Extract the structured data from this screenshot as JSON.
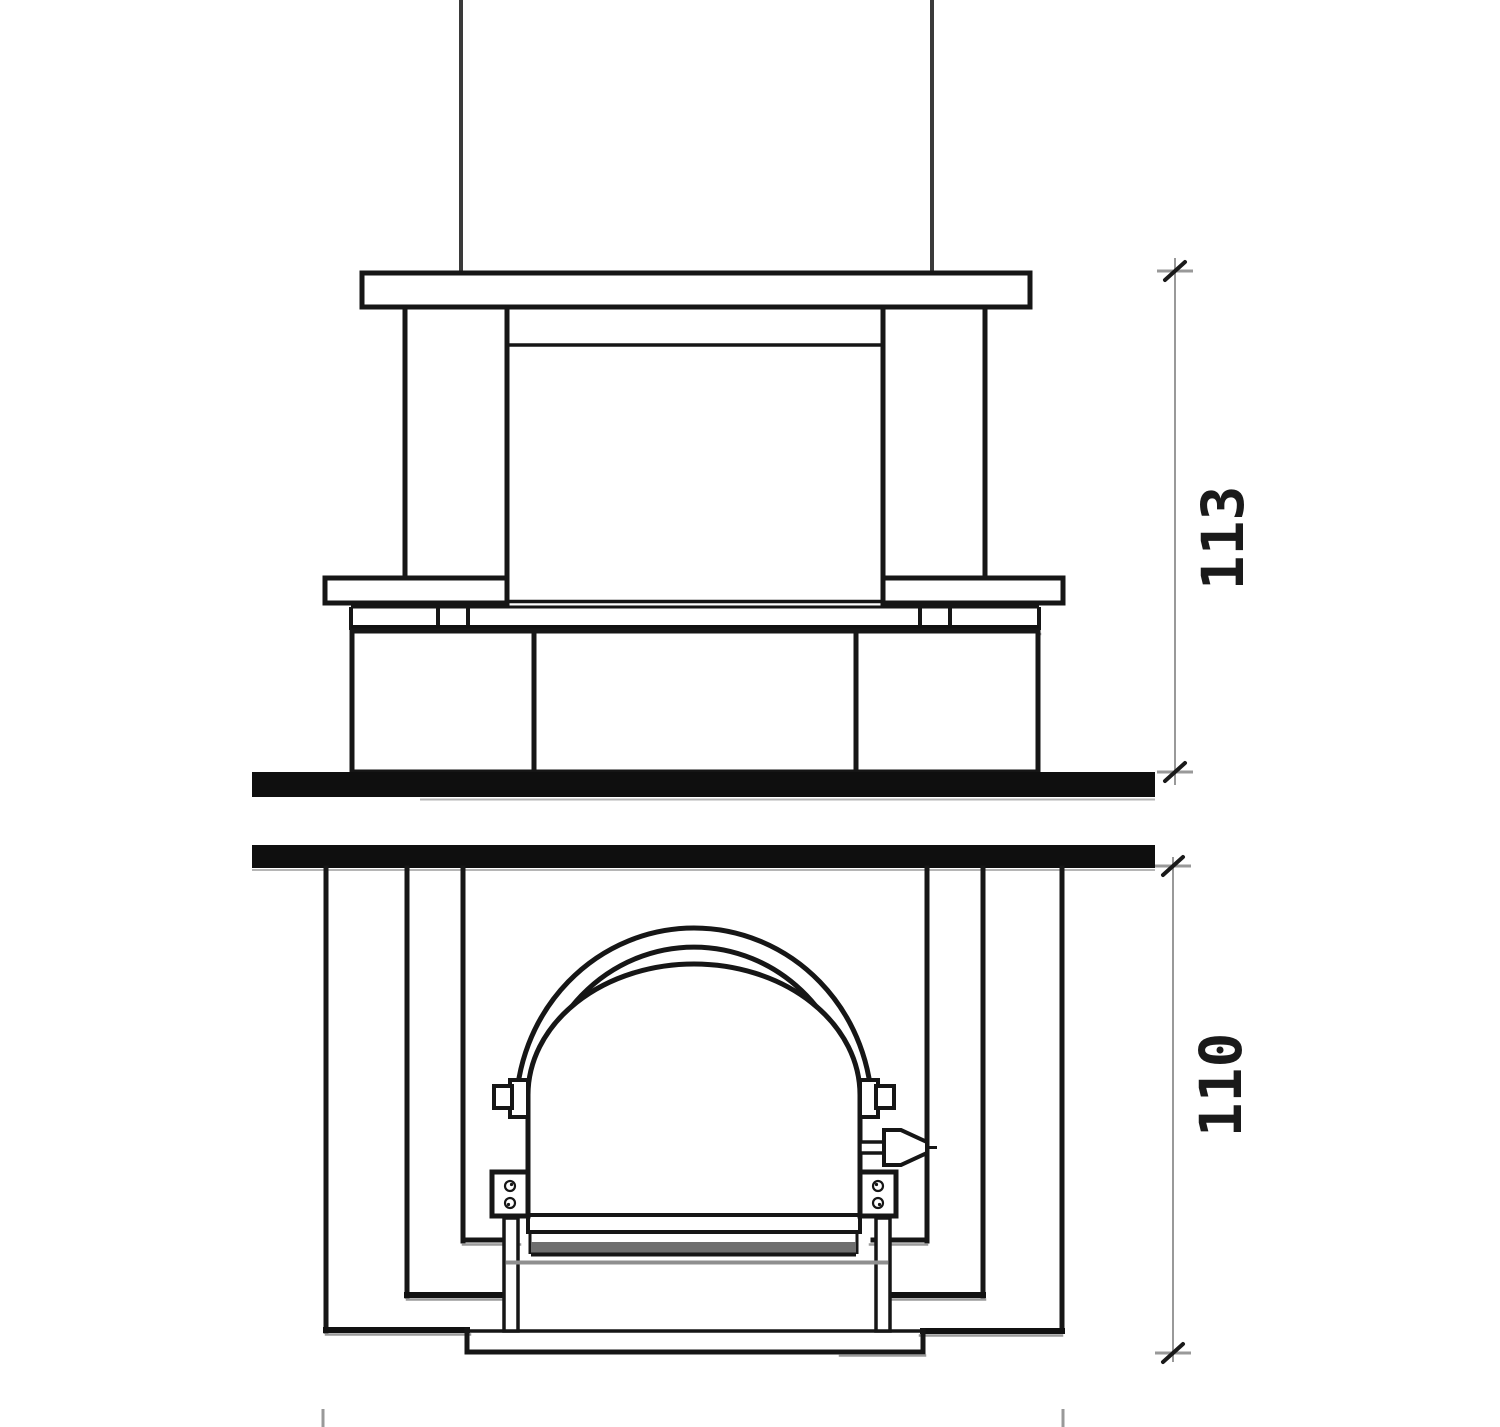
{
  "page": {
    "background": "#ffffff",
    "width": 1500,
    "height": 1427
  },
  "drawing": {
    "type": "technical-elevation",
    "subject": "masonry stove front elevation with fire door, split into upper unit and lower firebox unit by two bench slabs",
    "colors": {
      "line": "#161616",
      "thick_slab": "#0f0f0f",
      "shadow": "#9a9a9a",
      "gray_band": "#6e6e6e",
      "dimension_line": "#999999",
      "dimension_text": "#1a1a1a"
    },
    "dimensions": {
      "upper": {
        "label": "113",
        "value": 113,
        "orientation": "vertical",
        "measures": "upper unit height (cap top to bench slab)"
      },
      "lower": {
        "label": "110",
        "value": 110,
        "orientation": "vertical",
        "measures": "lower firebox unit height (bench underside to plinth base)"
      }
    }
  }
}
